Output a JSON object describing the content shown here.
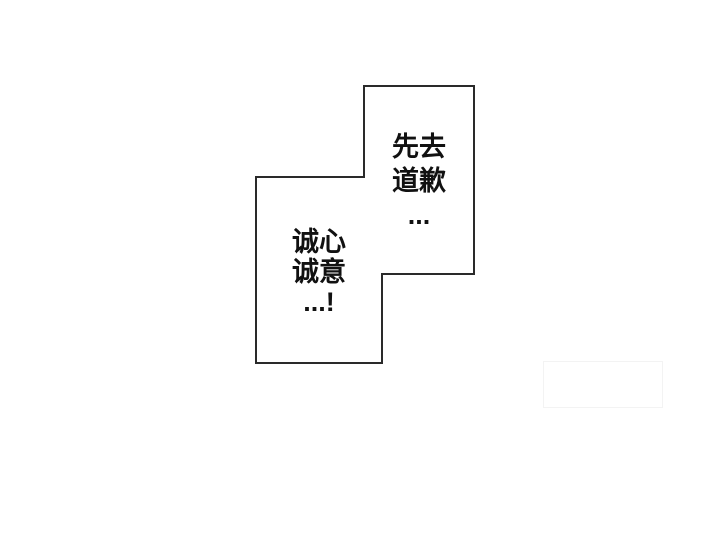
{
  "panel": {
    "background_color": "#ffffff",
    "outline_color": "#2a2a2a",
    "fill_color": "#ffffff",
    "polygon_points": "364,86 474,86 474,274 382,274 382,363 256,363 256,177 364,177",
    "bubbles": [
      {
        "id": "speech-bubble-right",
        "lines": [
          "先去",
          "道歉",
          "..."
        ]
      },
      {
        "id": "speech-bubble-left",
        "lines": [
          "诚心",
          "诚意",
          "...!"
        ]
      }
    ]
  },
  "artifact": {
    "border_color": "#f3f3f3"
  }
}
